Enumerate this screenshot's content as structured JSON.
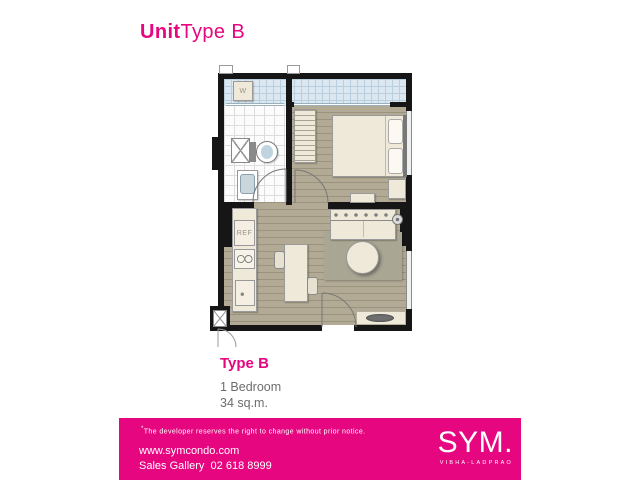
{
  "theme": {
    "brand": "#e6067f",
    "wall": "#161616",
    "floor_wood": "#b2aa94",
    "furniture": "#efe9da",
    "balcony_tile": "#dce8f1",
    "rug": "#a9a694"
  },
  "header": {
    "title_bold": "Unit",
    "title_light": "Type B"
  },
  "plan": {
    "washer_label": "W",
    "fridge_label": "REF"
  },
  "info": {
    "type_label": "Type B",
    "bedrooms": "1 Bedroom",
    "area": "34 sq.m."
  },
  "footer": {
    "disclaimer_mark": "*",
    "disclaimer_text": "The developer reserves the right to change without prior notice.",
    "website": "www.symcondo.com",
    "sales_label": "Sales Gallery",
    "phone": "02 618 8999",
    "logo_text": "SYM.",
    "logo_subtext": "VIBHA-LADPRAO"
  }
}
